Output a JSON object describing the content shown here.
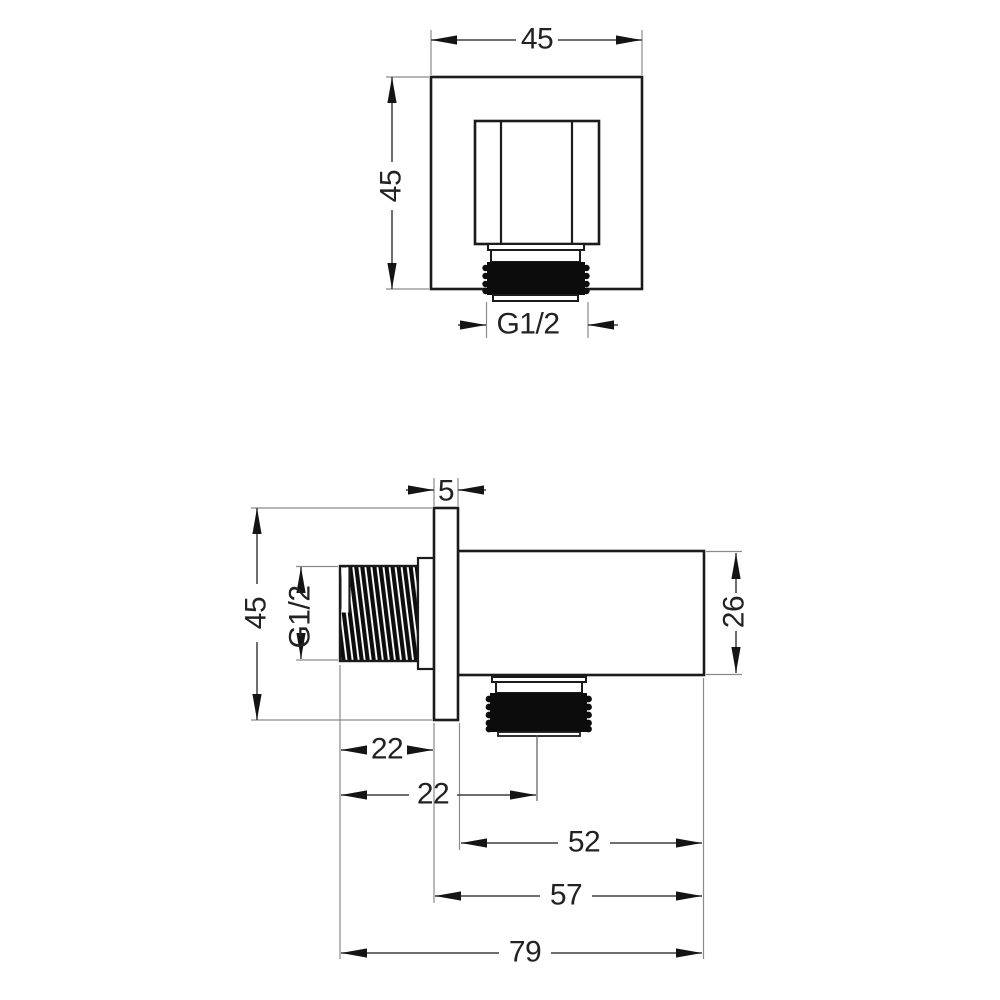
{
  "drawing_type": "technical dimension drawing",
  "product": "square shower wall outlet elbow, front and side views",
  "colors": {
    "background": "#ffffff",
    "outline": "#1b1b1b",
    "dimension_line": "#3f3f3f",
    "extension_line": "#8a8a8a",
    "thread_fill": "#0c0c0c",
    "text": "#222222"
  },
  "front_view": {
    "dims": {
      "width": "45",
      "height": "45",
      "thread": "G1/2"
    }
  },
  "side_view": {
    "dims": {
      "plate_thickness": "5",
      "plate_height": "45",
      "thread": "G1/2",
      "body_height": "26",
      "thread_length": "22",
      "outlet_center_offset": "22",
      "body_length": "52",
      "depth_without_thread": "57",
      "total_length": "79"
    }
  }
}
